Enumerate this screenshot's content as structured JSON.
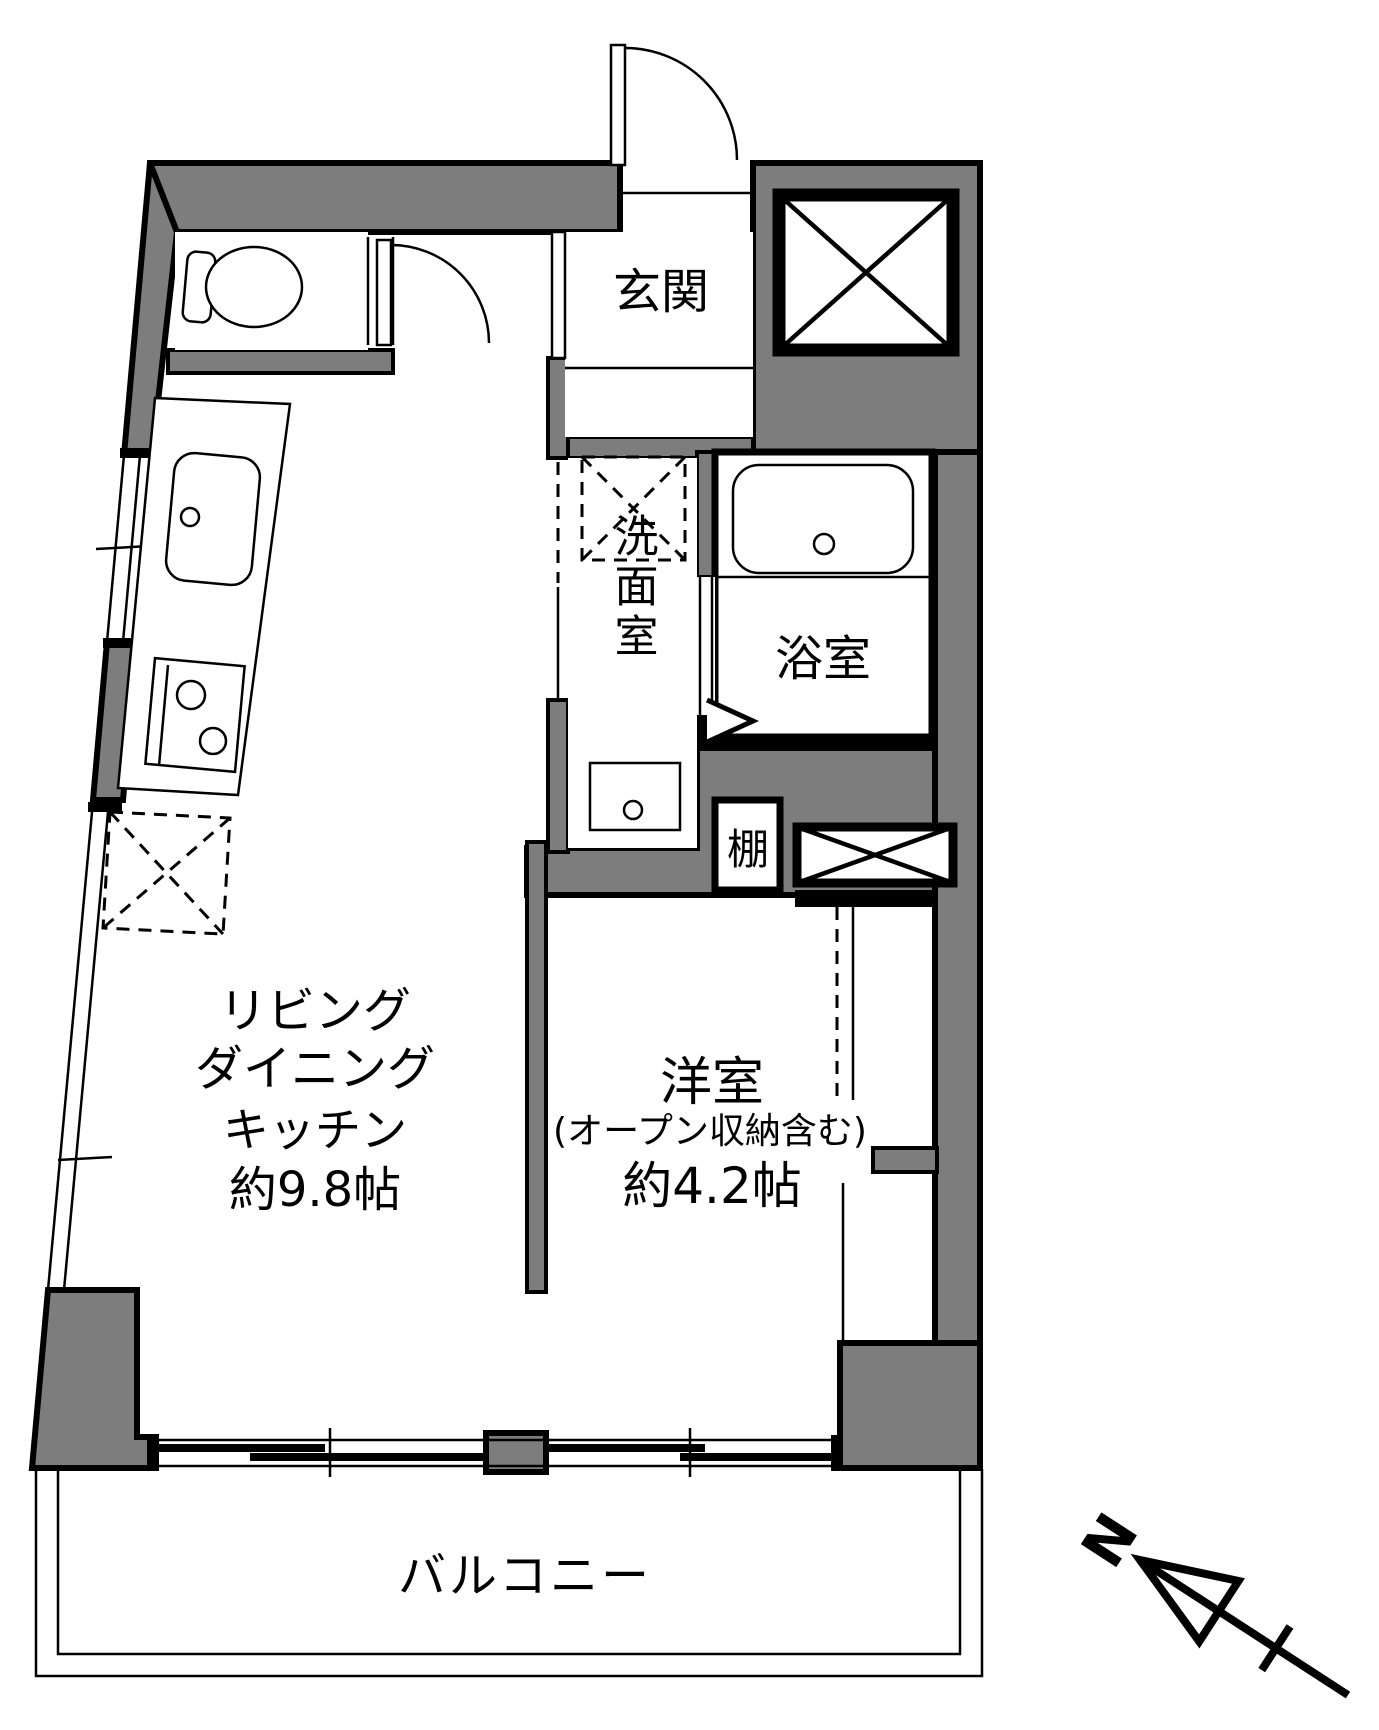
{
  "floorplan": {
    "rooms": {
      "entrance": {
        "label": "玄関"
      },
      "washroom": {
        "label": "洗面室"
      },
      "bathroom": {
        "label": "浴室"
      },
      "shelf": {
        "label": "棚"
      },
      "western_room": {
        "label": "洋室",
        "note": "(オープン収納含む)",
        "area": "約4.2帖"
      },
      "ldk": {
        "label_line1": "リビング",
        "label_line2": "ダイニング",
        "label_line3": "キッチン",
        "area": "約9.8帖"
      },
      "balcony": {
        "label": "バルコニー"
      }
    },
    "compass": {
      "north_label": "N"
    },
    "colors": {
      "wall_fill": "#7d7d7d",
      "line": "#000000",
      "background": "#ffffff"
    }
  }
}
